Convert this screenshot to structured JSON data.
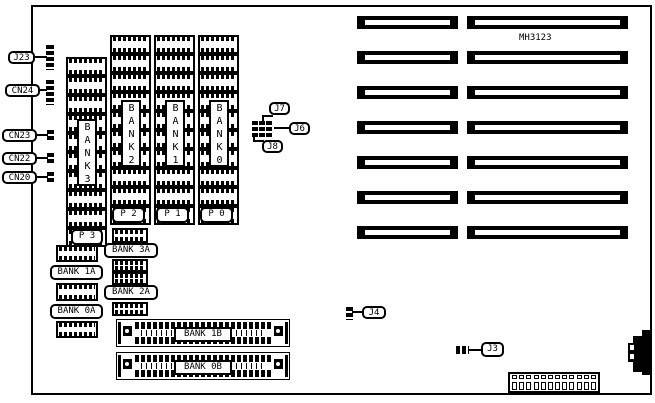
{
  "board": {
    "part_number": "MH3123"
  },
  "left_connectors": {
    "j23": "J23",
    "cn24": "CN24",
    "cn23": "CN23",
    "cn22": "CN22",
    "cn20": "CN20"
  },
  "memory": {
    "bank3": {
      "vertical_label": "BANK3",
      "port_label": "P 3"
    },
    "bank2": {
      "vertical_label": "BANK2",
      "port_label": "P 2"
    },
    "bank1": {
      "vertical_label": "BANK1",
      "port_label": "P 1"
    },
    "bank0": {
      "vertical_label": "BANK0",
      "port_label": "P 0"
    },
    "bank3a": "BANK 3A",
    "bank1a": "BANK 1A",
    "bank2a": "BANK 2A",
    "bank0a": "BANK 0A",
    "bank1b": "BANK 1B",
    "bank0b": "BANK 0B"
  },
  "jumpers": {
    "j7": "J7",
    "j6": "J6",
    "j8": "J8",
    "j4": "J4",
    "j3": "J3"
  }
}
